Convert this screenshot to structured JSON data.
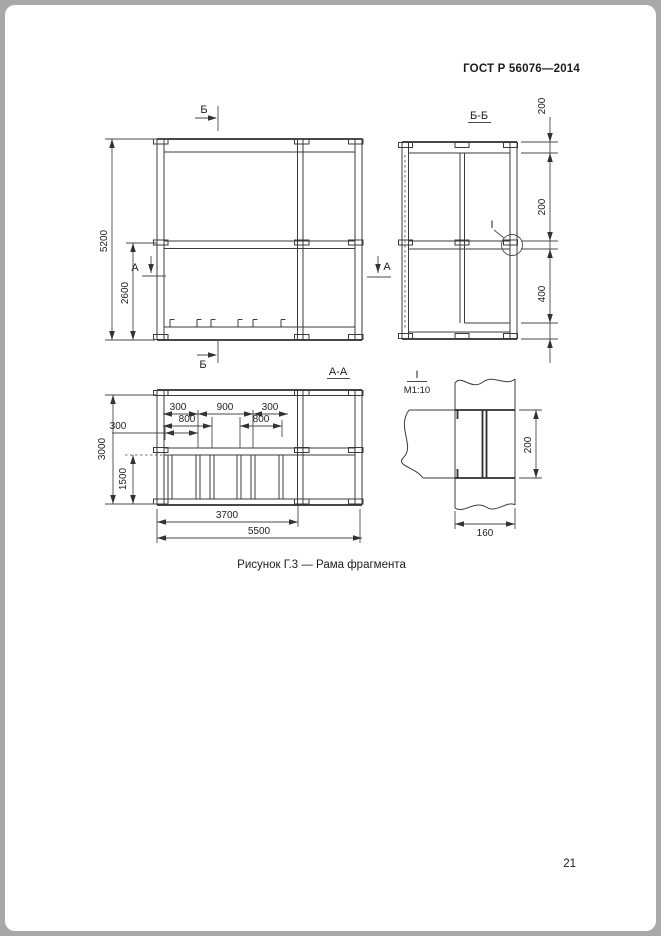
{
  "page": {
    "header": "ГОСТ Р 56076—2014",
    "caption": "Рисунок Г.3 — Рама фрагмента",
    "page_number": "21"
  },
  "front_view": {
    "dim_height_total": "5200",
    "dim_height_lower": "2600",
    "section_b": "Б",
    "section_a": "А"
  },
  "section_bb": {
    "title": "Б-Б",
    "dim_top_rail": "200",
    "dim_mid_rail": "200",
    "dim_bottom_rail": "400",
    "detail_mark": "I"
  },
  "section_aa": {
    "title": "А-А",
    "dim_row1": [
      "300",
      "900",
      "300"
    ],
    "dim_row2": [
      "800",
      "800"
    ],
    "dim_left_offset": "300",
    "dim_height_total": "3000",
    "dim_height_lower": "1500",
    "dim_width_inner": "3700",
    "dim_width_total": "5500"
  },
  "detail_i": {
    "mark": "I",
    "scale": "М1:10",
    "dim_height": "200",
    "dim_width": "160"
  }
}
